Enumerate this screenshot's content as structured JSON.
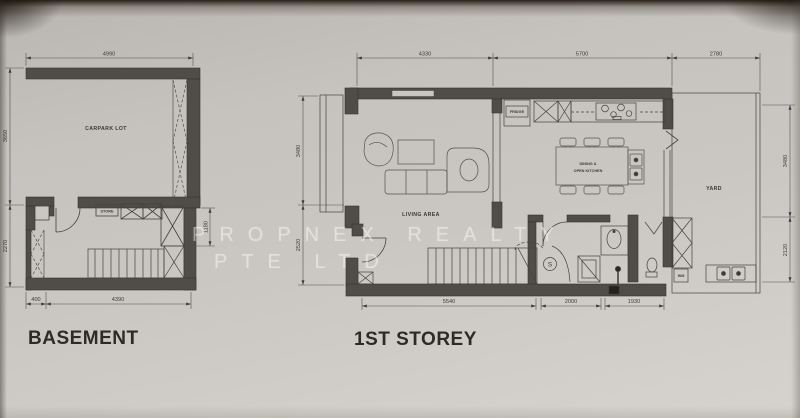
{
  "watermark": {
    "line1": "PROPNEX REALTY",
    "line2": "PTE LTD"
  },
  "basement": {
    "title": "BASEMENT",
    "labels": {
      "carpark": "CARPARK LOT",
      "store": "STORE"
    },
    "dims": {
      "top": "4990",
      "left_upper": "3650",
      "left_lower": "2270",
      "right": "1180",
      "bottom_small": "400",
      "bottom_large": "4390"
    }
  },
  "first_storey": {
    "title": "1ST STOREY",
    "labels": {
      "living": "LIVING AREA",
      "dining_line1": "DINING &",
      "dining_line2": "OPEN KITCHEN",
      "yard": "YARD",
      "fridge": "FRIDGE",
      "wm": "WM",
      "floor_trap": "S"
    },
    "dims": {
      "top_living": "4330",
      "top_kitchen": "5700",
      "top_yard": "2780",
      "left_upper": "3480",
      "left_lower": "2520",
      "right_upper": "3480",
      "right_lower": "2120",
      "bottom_left": "5540",
      "bottom_mid": "2000",
      "bottom_right": "1930"
    }
  }
}
